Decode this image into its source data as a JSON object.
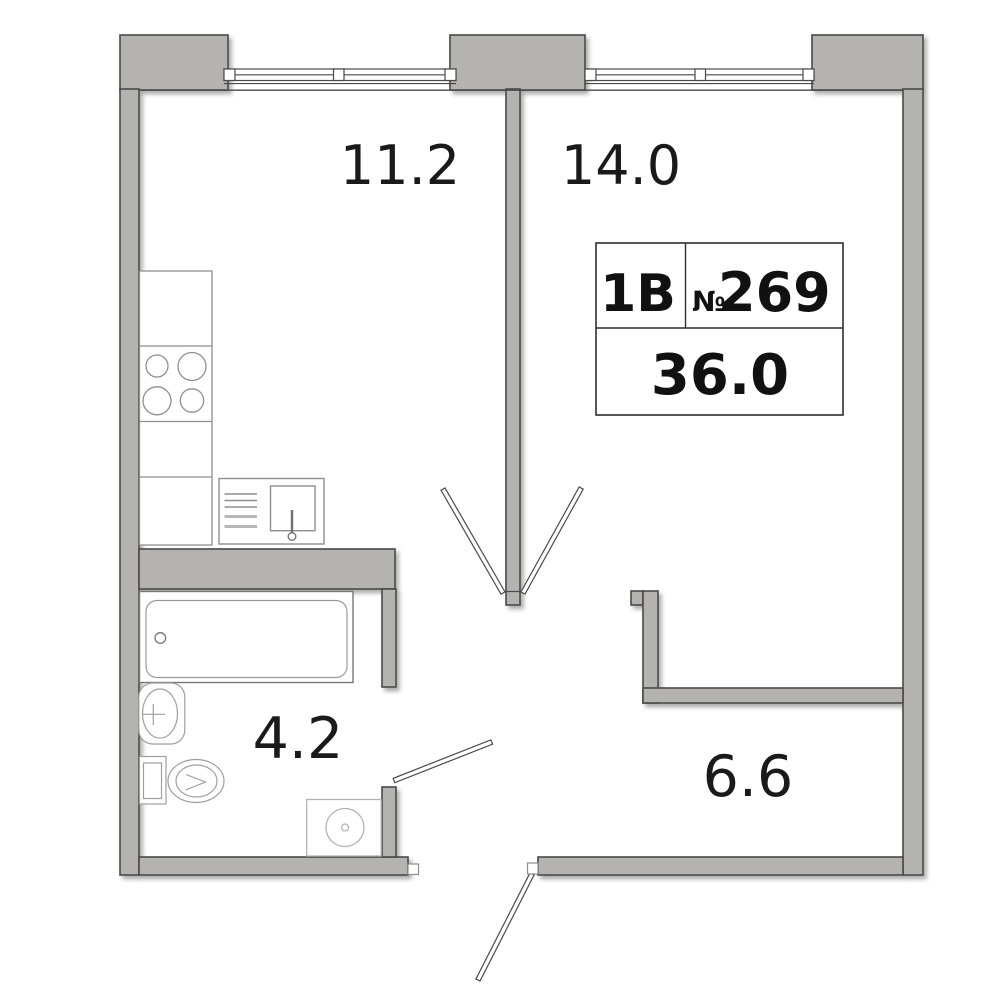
{
  "unit": {
    "type_label": "1В",
    "number_sign": "№",
    "number": "269",
    "total_area": "36.0"
  },
  "rooms": {
    "kitchen": {
      "area": "11.2"
    },
    "living_room": {
      "area": "14.0"
    },
    "bathroom": {
      "area": "4.2"
    },
    "hallway": {
      "area": "6.6"
    }
  },
  "colors": {
    "background": "#ffffff",
    "wall_fill": "#b5b3b0",
    "wall_outline": "#4a4a4a",
    "fixture_stroke": "#979797",
    "light_fixture_stroke": "#b3b3b3",
    "info_box_border": "#2f2f2f",
    "text": "#1a1a1a"
  },
  "fixtures": [
    "window-icon",
    "window-icon",
    "stove-burners-icon",
    "kitchen-counter-icon",
    "kitchen-sink-icon",
    "bathtub-icon",
    "washbasin-icon",
    "toilet-icon",
    "washing-machine-icon",
    "door-leaf-icon",
    "door-leaf-icon",
    "door-leaf-icon",
    "door-leaf-icon"
  ]
}
